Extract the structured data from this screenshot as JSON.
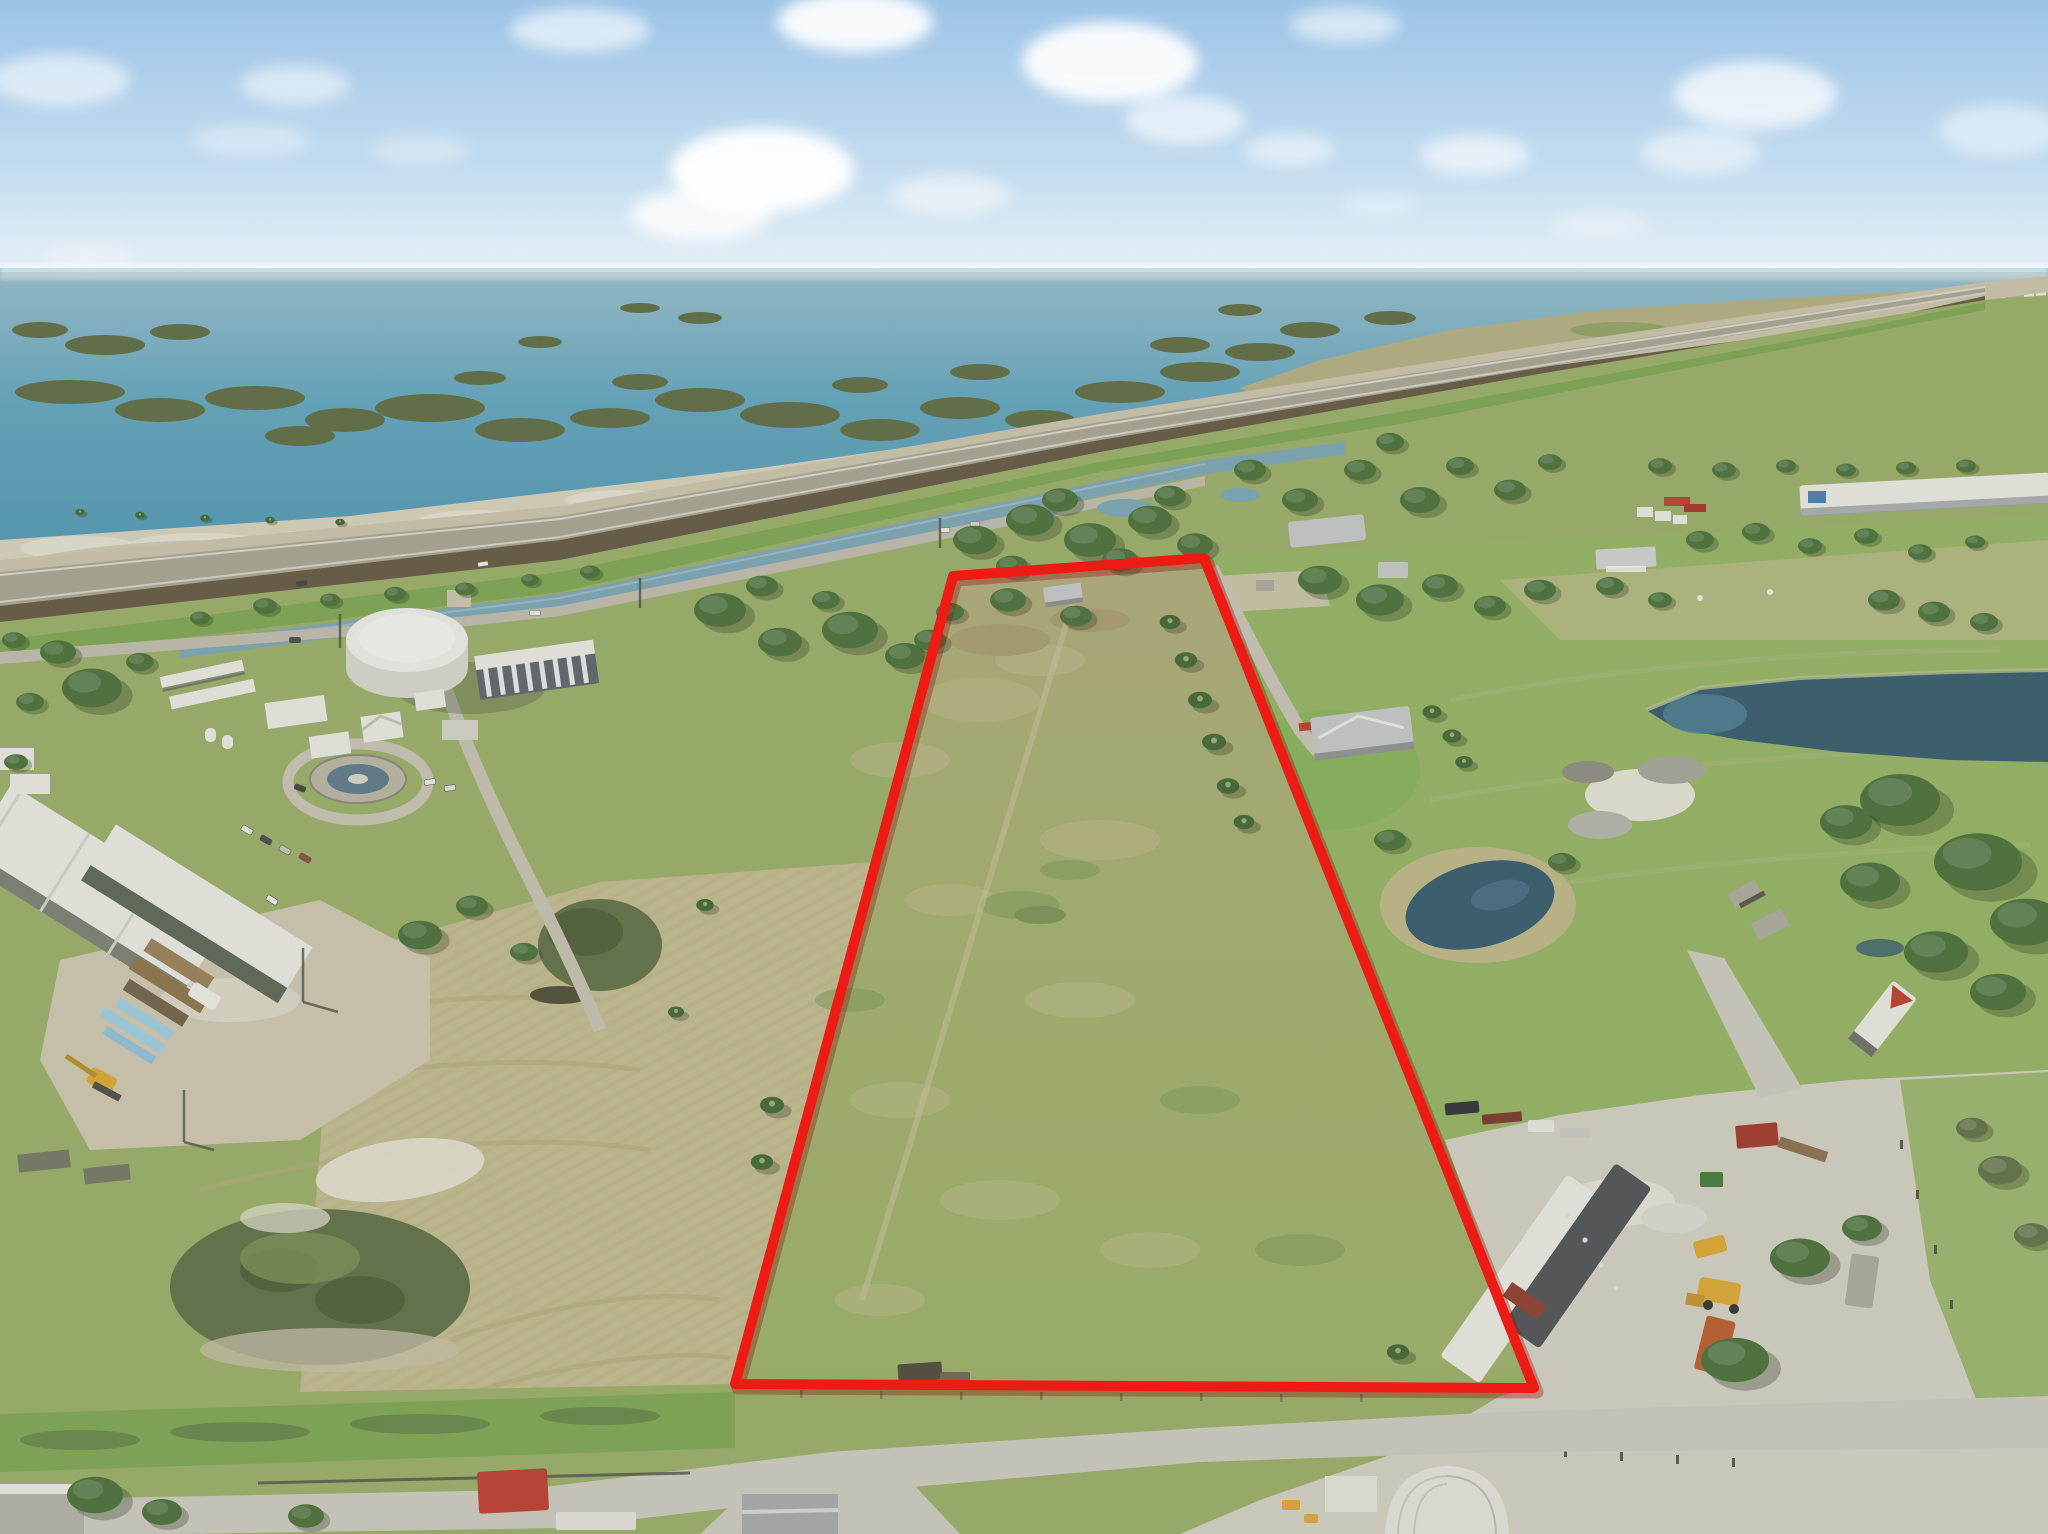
{
  "image": {
    "type": "aerial-drone-photograph",
    "subject": "Vacant land parcel outlined in red, lakefront rural property",
    "description": "High-angle drone photo: blue sky with clouds over a wide lake dotted with marsh islands; a highway causeway crosses diagonally; below it a canal, a water-treatment plant with a large white storage tank on the left, tan mowed hay fields, a long red-outlined pasture parcel in the center, neighboring homes, ponds, and an equipment/dirt yard at lower right with trailers and loaders; dirt roads along the bottom.",
    "visible_text": [],
    "parcel_boundary_color": "#ee1b15"
  },
  "boundary": {
    "points": "953,576 1204,558 1534,1388 735,1384",
    "stroke_width": 10
  },
  "scene": {
    "elements": [
      "sky",
      "clouds",
      "lake",
      "marsh-islands",
      "distant-town",
      "highway-causeway",
      "embankment",
      "canal",
      "water-treatment-plant",
      "white-storage-tank",
      "clarifier-basin",
      "warehouse",
      "carport-sheds",
      "mowed-hay-field",
      "brush-mound",
      "outlined-parcel",
      "palm-tree-rows",
      "neighbor-house",
      "driveway",
      "retention-ponds",
      "equipment-yard",
      "office-trailers",
      "wheel-loader",
      "semi-trailer",
      "quonset-hut",
      "dirt-roads",
      "red-container",
      "power-poles"
    ]
  },
  "palette": {
    "sky_top": "#9cc3e6",
    "sky_mid": "#c6def0",
    "sky_horizon": "#ecf4f8",
    "cloud": "#ffffff",
    "water_far": "#99c2d5",
    "water_mid": "#5ea7c4",
    "water_near": "#4a97b8",
    "island": "#5c6b41",
    "island_light": "#6e7d4d",
    "marsh_tan": "#b6b286",
    "marsh_green": "#8da25d",
    "marsh_pool": "#9cc4d0",
    "town": "#f2f4f4",
    "cause_sand": "#d0c8af",
    "road_grey": "#aba797",
    "road_white": "#e8e6db",
    "embank": "#62553f",
    "verge_green": "#7da850",
    "canal": "#7aa8bb",
    "frontage": "#c3c0b1",
    "land_base": "#9cb168",
    "beach": "#dcd6c1",
    "sand_white": "#ebe8da",
    "tan_field": "#c6bf92",
    "tan_stripe": "#b4ab7c",
    "parcel_top": "#b2ad7a",
    "parcel_mid": "#a6b26e",
    "parcel_low": "#9cb467",
    "pasture": "#96b763",
    "lawn": "#82b556",
    "tree": "#456f36",
    "palm": "#3c6531",
    "shrub": "#5f7044",
    "shrub_dark": "#4c5c36",
    "dirt": "#d3cab4",
    "yard": "#d8d4c9",
    "road_dirt": "#d2cfc5",
    "pond_dark": "#30576d",
    "pond_mid": "#497e98",
    "reed": "#c4bb8a",
    "white_bldg": "#f1f1ec",
    "roof_grey": "#c9cccd",
    "col_dark": "#5a646d",
    "tank_white": "#f4f4f0",
    "red_shadow": "#8e0d09",
    "container_red": "#c0392b",
    "rust": "#8e3a2a",
    "orange": "#c05a28",
    "yellow_equip": "#e2aa2e",
    "blue_acc": "#3e7fb5",
    "kayak": "#9fd3e8",
    "grey_struct": "#b0ada0",
    "dark_trailer": "#4a4f55"
  }
}
